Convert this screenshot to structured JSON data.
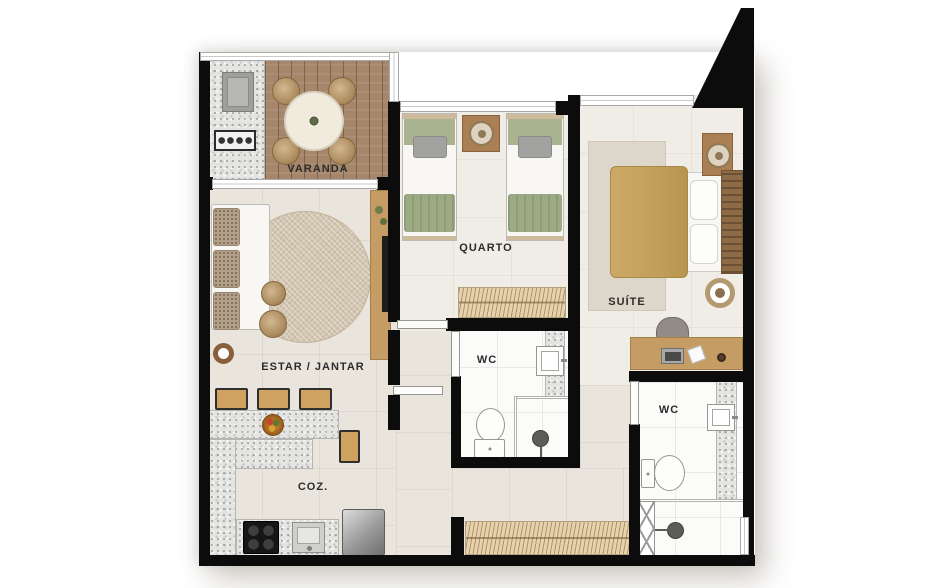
{
  "plan_title": "Apartment floor plan",
  "rooms": {
    "varanda": {
      "label": "VARANDA"
    },
    "quarto": {
      "label": "QUARTO"
    },
    "suite": {
      "label": "SUÍTE"
    },
    "estar_jantar": {
      "label": "ESTAR / JANTAR"
    },
    "cozinha": {
      "label": "COZ."
    },
    "wc_social": {
      "label": "WC"
    },
    "wc_suite": {
      "label": "WC"
    }
  },
  "furniture": {
    "varanda": [
      "support-sink",
      "grill",
      "round-dining-table",
      "four-chairs"
    ],
    "estar_jantar": [
      "sofa",
      "round-rug",
      "two-poufs",
      "side-table",
      "tv-panel"
    ],
    "cozinha": [
      "l-shaped-counter",
      "four-bar-stools",
      "fruit-bowl",
      "cooktop",
      "sink",
      "refrigerator"
    ],
    "quarto": [
      "twin-bed",
      "twin-bed",
      "nightstand-with-lamp",
      "wardrobe"
    ],
    "suite": [
      "double-bed",
      "nightstand-with-lamp",
      "rug",
      "pouf",
      "desk",
      "desk-chair",
      "wardrobe"
    ],
    "wc_social": [
      "washbasin",
      "toilet",
      "shower"
    ],
    "wc_suite": [
      "washbasin",
      "toilet",
      "shower-box"
    ]
  },
  "colors": {
    "wall": "#0c0c0c",
    "floor_living": "#e9e5dd",
    "floor_bedroom": "#f0ede6",
    "floor_bath": "#fbfbfa",
    "deck": "#a5866a",
    "granite": "#e4e4e2",
    "wardrobe": "#e7d2ab",
    "wood": "#c49c64",
    "wood_dark": "#a97f53",
    "rug": "#d4c7b2",
    "bed_green": "#a9b390",
    "bed_camel": "#c6a35f",
    "label": "#2c2c2c"
  }
}
